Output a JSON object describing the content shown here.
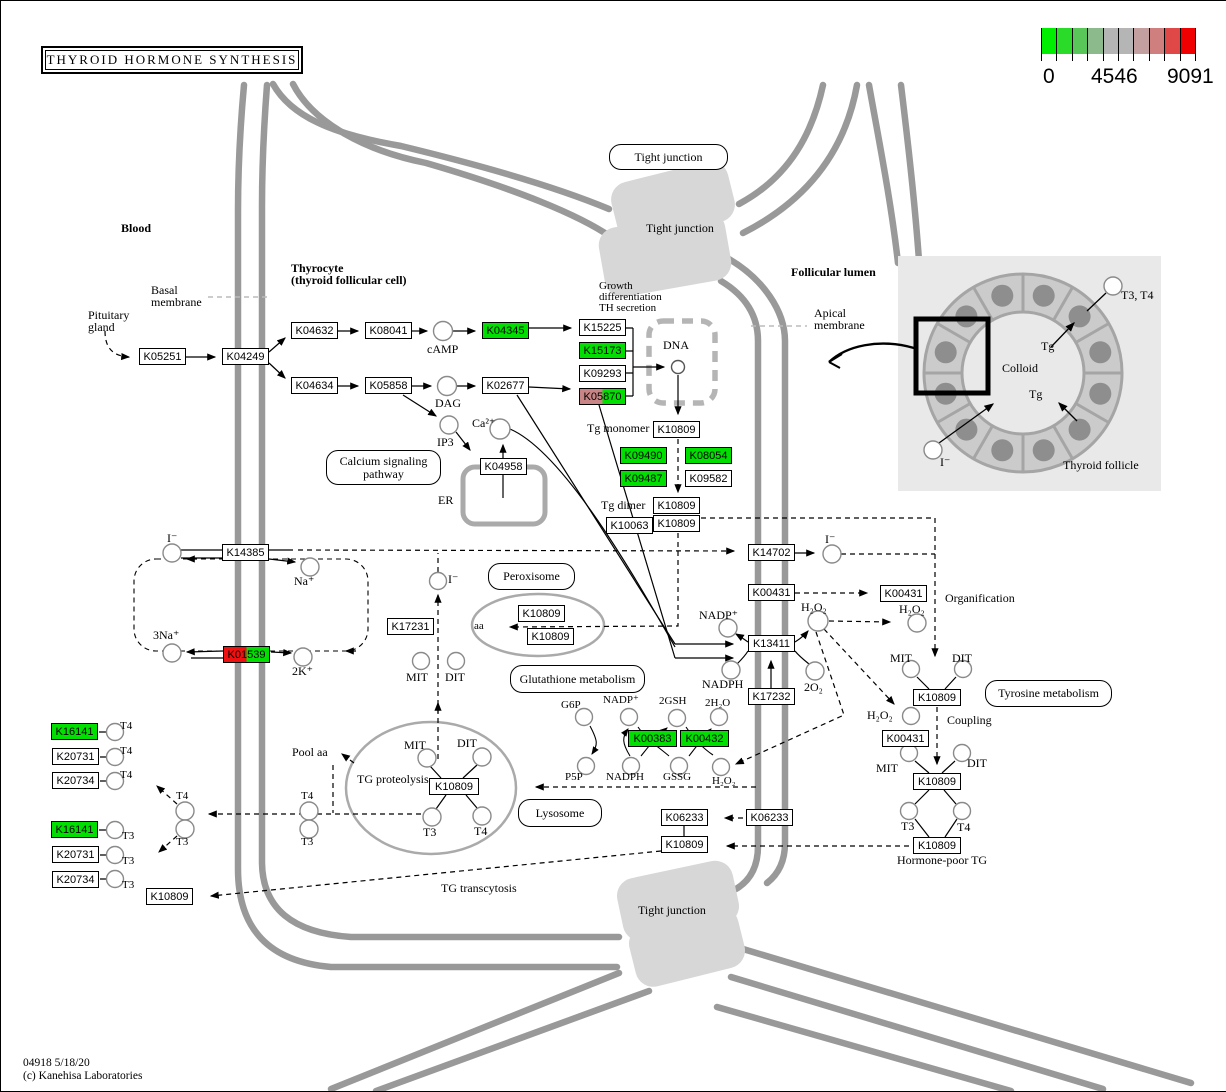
{
  "title": "THYROID HORMONE SYNTHESIS",
  "legend": {
    "ticks": [
      "0",
      "4546",
      "9091"
    ],
    "colors": [
      "#00EE00",
      "#2ADB2A",
      "#59C659",
      "#8CBA8C",
      "#B5B5B5",
      "#B5B5B5",
      "#C49F9F",
      "#D07F7F",
      "#E04848",
      "#F00000"
    ]
  },
  "footer": {
    "line1": "04918 5/18/20",
    "line2": "(c) Kanehisa Laboratories"
  },
  "box_colors": {
    "green": "#00DF00",
    "red": "#F01010",
    "rose": "#C98585",
    "white": "#FFFFFF"
  },
  "pathway_links": [
    {
      "lines": [
        "Tight junction"
      ],
      "x": 608,
      "y": 143,
      "w": 119,
      "h": 26
    },
    {
      "lines": [
        "Calcium signaling",
        "pathway"
      ],
      "x": 325,
      "y": 449,
      "w": 115,
      "h": 35
    },
    {
      "lines": [
        "Peroxisome"
      ],
      "x": 487,
      "y": 562,
      "w": 87,
      "h": 27
    },
    {
      "lines": [
        "Glutathione metabolism"
      ],
      "x": 509,
      "y": 664,
      "w": 135,
      "h": 28
    },
    {
      "lines": [
        "Lysosome"
      ],
      "x": 517,
      "y": 798,
      "w": 84,
      "h": 28
    },
    {
      "lines": [
        "Tyrosine metabolism"
      ],
      "x": 984,
      "y": 679,
      "w": 127,
      "h": 27
    }
  ],
  "ko_boxes": [
    {
      "label": "K05251",
      "x": 138,
      "y": 347
    },
    {
      "label": "K04249",
      "x": 221,
      "y": 347
    },
    {
      "label": "K04632",
      "x": 290,
      "y": 321
    },
    {
      "label": "K08041",
      "x": 364,
      "y": 321
    },
    {
      "label": "K04345",
      "x": 481,
      "y": 321,
      "c": "#00DF00"
    },
    {
      "label": "K15225",
      "x": 578,
      "y": 318
    },
    {
      "label": "K15173",
      "x": 578,
      "y": 341,
      "c": "#00DF00"
    },
    {
      "label": "K09293",
      "x": 578,
      "y": 364
    },
    {
      "label": "K05870",
      "x": 578,
      "y": 387,
      "c": "#C98585",
      "c2": "#00DF00"
    },
    {
      "label": "K04634",
      "x": 290,
      "y": 376
    },
    {
      "label": "K05858",
      "x": 364,
      "y": 376
    },
    {
      "label": "K02677",
      "x": 481,
      "y": 376
    },
    {
      "label": "K04958",
      "x": 479,
      "y": 457
    },
    {
      "label": "K10809",
      "x": 652,
      "y": 420
    },
    {
      "label": "K09490",
      "x": 619,
      "y": 446,
      "c": "#00DF00"
    },
    {
      "label": "K08054",
      "x": 684,
      "y": 446,
      "c": "#00DF00"
    },
    {
      "label": "K09487",
      "x": 619,
      "y": 469,
      "c": "#00DF00"
    },
    {
      "label": "K09582",
      "x": 684,
      "y": 469
    },
    {
      "label": "K10809",
      "x": 652,
      "y": 496
    },
    {
      "label": "K10809",
      "x": 652,
      "y": 514
    },
    {
      "label": "K10063",
      "x": 605,
      "y": 516
    },
    {
      "label": "K14385",
      "x": 221,
      "y": 543
    },
    {
      "label": "K01539",
      "x": 222,
      "y": 645,
      "c": "#F01010",
      "c2": "#00DF00"
    },
    {
      "label": "K17231",
      "x": 386,
      "y": 617
    },
    {
      "label": "K14702",
      "x": 747,
      "y": 543
    },
    {
      "label": "K00431",
      "x": 747,
      "y": 583
    },
    {
      "label": "K13411",
      "x": 747,
      "y": 634
    },
    {
      "label": "K17232",
      "x": 747,
      "y": 687
    },
    {
      "label": "K00431",
      "x": 879,
      "y": 584
    },
    {
      "label": "K10809",
      "x": 517,
      "y": 604
    },
    {
      "label": "K10809",
      "x": 526,
      "y": 627
    },
    {
      "label": "K00383",
      "x": 627,
      "y": 729,
      "c": "#00DF00",
      "w": 49
    },
    {
      "label": "K00432",
      "x": 679,
      "y": 729,
      "c": "#00DF00",
      "w": 49
    },
    {
      "label": "K10809",
      "x": 428,
      "y": 777,
      "w": 50
    },
    {
      "label": "K16141",
      "x": 50,
      "y": 722,
      "c": "#00DF00"
    },
    {
      "label": "K20731",
      "x": 51,
      "y": 747
    },
    {
      "label": "K20734",
      "x": 51,
      "y": 771
    },
    {
      "label": "K16141",
      "x": 50,
      "y": 820,
      "c": "#00DF00"
    },
    {
      "label": "K20731",
      "x": 51,
      "y": 845
    },
    {
      "label": "K20734",
      "x": 51,
      "y": 870
    },
    {
      "label": "K10809",
      "x": 145,
      "y": 887
    },
    {
      "label": "K06233",
      "x": 660,
      "y": 808
    },
    {
      "label": "K10809",
      "x": 660,
      "y": 835
    },
    {
      "label": "K06233",
      "x": 745,
      "y": 808
    },
    {
      "label": "K10809",
      "x": 912,
      "y": 688,
      "w": 48
    },
    {
      "label": "K00431",
      "x": 881,
      "y": 729
    },
    {
      "label": "K10809",
      "x": 912,
      "y": 772,
      "w": 48
    },
    {
      "label": "K10809",
      "x": 912,
      "y": 836,
      "w": 48
    }
  ],
  "metabolites": [
    {
      "name": "cAMP",
      "cx": 442,
      "cy": 330,
      "r": 9.5
    },
    {
      "name": "DAG",
      "cx": 446,
      "cy": 385,
      "r": 9.5
    },
    {
      "name": "IP3",
      "cx": 448,
      "cy": 424,
      "r": 9
    },
    {
      "name": "Ca2+",
      "cx": 499,
      "cy": 428,
      "r": 10
    },
    {
      "name": "DNA-site",
      "cx": 677,
      "cy": 366,
      "r": 6.5
    },
    {
      "name": "iodide-blood",
      "cx": 171,
      "cy": 552,
      "r": 9
    },
    {
      "name": "Na+",
      "cx": 309,
      "cy": 566,
      "r": 9
    },
    {
      "name": "3Na+",
      "cx": 171,
      "cy": 652,
      "r": 9
    },
    {
      "name": "2K+",
      "cx": 302,
      "cy": 656,
      "r": 9
    },
    {
      "name": "iodide-recycled",
      "cx": 437,
      "cy": 580,
      "r": 8.5
    },
    {
      "name": "MIT-dehal",
      "cx": 420,
      "cy": 660,
      "r": 8.5
    },
    {
      "name": "DIT-dehal",
      "cx": 455,
      "cy": 660,
      "r": 8.5
    },
    {
      "name": "T4-blood",
      "cx": 184,
      "cy": 810,
      "r": 9
    },
    {
      "name": "T3-blood",
      "cx": 184,
      "cy": 828,
      "r": 9
    },
    {
      "name": "T4-cell",
      "cx": 308,
      "cy": 810,
      "r": 9
    },
    {
      "name": "T3-cell",
      "cx": 308,
      "cy": 828,
      "r": 9
    },
    {
      "name": "T4-transport-1",
      "cx": 114,
      "cy": 731,
      "r": 8.5
    },
    {
      "name": "T4-transport-2",
      "cx": 114,
      "cy": 756,
      "r": 8.5
    },
    {
      "name": "T4-transport-3",
      "cx": 114,
      "cy": 780,
      "r": 8.5
    },
    {
      "name": "T3-transport-1",
      "cx": 114,
      "cy": 829,
      "r": 8.5
    },
    {
      "name": "T3-transport-2",
      "cx": 114,
      "cy": 854,
      "r": 8.5
    },
    {
      "name": "T3-transport-3",
      "cx": 114,
      "cy": 878,
      "r": 8.5
    },
    {
      "name": "MIT-lysosome",
      "cx": 426,
      "cy": 757,
      "r": 9
    },
    {
      "name": "DIT-lysosome",
      "cx": 481,
      "cy": 756,
      "r": 9
    },
    {
      "name": "T3-lysosome",
      "cx": 431,
      "cy": 816,
      "r": 9
    },
    {
      "name": "T4-lysosome",
      "cx": 481,
      "cy": 815,
      "r": 9
    },
    {
      "name": "G6P",
      "cx": 583,
      "cy": 716,
      "r": 8.5
    },
    {
      "name": "NADP-glut",
      "cx": 628,
      "cy": 716,
      "r": 8.5
    },
    {
      "name": "2GSH",
      "cx": 676,
      "cy": 717,
      "r": 8.5
    },
    {
      "name": "2H2O",
      "cx": 718,
      "cy": 716,
      "r": 8.5
    },
    {
      "name": "P5P",
      "cx": 585,
      "cy": 765,
      "r": 8.5
    },
    {
      "name": "NADPH-glut",
      "cx": 630,
      "cy": 765,
      "r": 8.5
    },
    {
      "name": "GSSG",
      "cx": 678,
      "cy": 765,
      "r": 8.5
    },
    {
      "name": "H2O2-glut",
      "cx": 720,
      "cy": 766,
      "r": 8.5
    },
    {
      "name": "NADP-duox",
      "cx": 727,
      "cy": 627,
      "r": 9
    },
    {
      "name": "NADPH-duox",
      "cx": 730,
      "cy": 669,
      "r": 9
    },
    {
      "name": "H2O2-apical",
      "cx": 817,
      "cy": 620,
      "r": 10
    },
    {
      "name": "2O2",
      "cx": 814,
      "cy": 670,
      "r": 9
    },
    {
      "name": "iodide-lumen",
      "cx": 831,
      "cy": 553,
      "r": 9
    },
    {
      "name": "H2O2-organification",
      "cx": 916,
      "cy": 622,
      "r": 9
    },
    {
      "name": "MIT-lumen",
      "cx": 910,
      "cy": 668,
      "r": 8.5
    },
    {
      "name": "DIT-lumen",
      "cx": 962,
      "cy": 668,
      "r": 8.5
    },
    {
      "name": "H2O2-coupling",
      "cx": 910,
      "cy": 715,
      "r": 8.5
    },
    {
      "name": "MIT-coupling",
      "cx": 908,
      "cy": 752,
      "r": 8.5
    },
    {
      "name": "DIT-coupling",
      "cx": 961,
      "cy": 752,
      "r": 8.5
    },
    {
      "name": "T3-lumen",
      "cx": 908,
      "cy": 810,
      "r": 8.5
    },
    {
      "name": "T4-lumen",
      "cx": 961,
      "cy": 810,
      "r": 8.5
    },
    {
      "name": "T3T4-follicle",
      "cx": 1112,
      "cy": 285,
      "r": 9
    },
    {
      "name": "iodide-follicle",
      "cx": 932,
      "cy": 449,
      "r": 9
    }
  ],
  "labels": [
    {
      "t": "Blood",
      "x": 120,
      "y": 221,
      "b": 1
    },
    {
      "t": "Thyrocyte",
      "x": 290,
      "y": 261,
      "b": 1
    },
    {
      "t": "(thyroid follicular cell)",
      "x": 290,
      "y": 273,
      "b": 1
    },
    {
      "t": "Follicular lumen",
      "x": 790,
      "y": 265,
      "b": 1
    },
    {
      "t": "Basal",
      "x": 150,
      "y": 283
    },
    {
      "t": "membrane",
      "x": 150,
      "y": 295
    },
    {
      "t": "Pituitary",
      "x": 87,
      "y": 308
    },
    {
      "t": "gland",
      "x": 87,
      "y": 320
    },
    {
      "t": "Apical",
      "x": 813,
      "y": 306
    },
    {
      "t": "membrane",
      "x": 813,
      "y": 318
    },
    {
      "t": "Growth",
      "x": 598,
      "y": 279,
      "s": 11
    },
    {
      "t": "differentiation",
      "x": 598,
      "y": 290,
      "s": 11
    },
    {
      "t": "TH secretion",
      "x": 598,
      "y": 301,
      "s": 11
    },
    {
      "t": "cAMP",
      "x": 426,
      "y": 342
    },
    {
      "t": "DAG",
      "x": 434,
      "y": 396
    },
    {
      "t": "IP3",
      "x": 436,
      "y": 435
    },
    {
      "t": "Ca²⁺",
      "x": 471,
      "y": 416
    },
    {
      "t": "ER",
      "x": 437,
      "y": 493
    },
    {
      "t": "DNA",
      "x": 662,
      "y": 338
    },
    {
      "t": "Tg monomer",
      "x": 586,
      "y": 421
    },
    {
      "t": "Tg dimer",
      "x": 600,
      "y": 498
    },
    {
      "t": "aa",
      "x": 473,
      "y": 619,
      "s": 11
    },
    {
      "t": "I⁻",
      "x": 166,
      "y": 531
    },
    {
      "t": "Na⁺",
      "x": 293,
      "y": 574
    },
    {
      "t": "3Na⁺",
      "x": 152,
      "y": 628
    },
    {
      "t": "2K⁺",
      "x": 291,
      "y": 664
    },
    {
      "t": "I⁻",
      "x": 447,
      "y": 572
    },
    {
      "t": "MIT",
      "x": 405,
      "y": 670
    },
    {
      "t": "DIT",
      "x": 444,
      "y": 670
    },
    {
      "t": "NADP⁺",
      "x": 698,
      "y": 608
    },
    {
      "t": "NADPH",
      "x": 701,
      "y": 677
    },
    {
      "t": "H₂O₂",
      "x": 800,
      "y": 600
    },
    {
      "t": "2O₂",
      "x": 803,
      "y": 680
    },
    {
      "t": "H₂O₂",
      "x": 898,
      "y": 602
    },
    {
      "t": "I⁻",
      "x": 824,
      "y": 532
    },
    {
      "t": "Organification",
      "x": 944,
      "y": 591
    },
    {
      "t": "MIT",
      "x": 889,
      "y": 651
    },
    {
      "t": "DIT",
      "x": 951,
      "y": 651
    },
    {
      "t": "H₂O₂",
      "x": 866,
      "y": 708
    },
    {
      "t": "Coupling",
      "x": 946,
      "y": 713
    },
    {
      "t": "MIT",
      "x": 875,
      "y": 761
    },
    {
      "t": "DIT",
      "x": 966,
      "y": 756
    },
    {
      "t": "T3",
      "x": 900,
      "y": 819
    },
    {
      "t": "T4",
      "x": 956,
      "y": 820
    },
    {
      "t": "Hormone-poor TG",
      "x": 896,
      "y": 853
    },
    {
      "t": "G6P",
      "x": 560,
      "y": 698,
      "s": 11
    },
    {
      "t": "NADP⁺",
      "x": 602,
      "y": 693,
      "s": 11
    },
    {
      "t": "2GSH",
      "x": 658,
      "y": 694,
      "s": 11
    },
    {
      "t": "2H₂O",
      "x": 704,
      "y": 696,
      "s": 11
    },
    {
      "t": "P5P",
      "x": 564,
      "y": 770,
      "s": 11
    },
    {
      "t": "NADPH",
      "x": 605,
      "y": 770,
      "s": 11
    },
    {
      "t": "GSSG",
      "x": 662,
      "y": 770,
      "s": 11
    },
    {
      "t": "H₂O₂",
      "x": 711,
      "y": 774,
      "s": 11
    },
    {
      "t": "TG proteolysis",
      "x": 356,
      "y": 772
    },
    {
      "t": "MIT",
      "x": 403,
      "y": 738
    },
    {
      "t": "DIT",
      "x": 456,
      "y": 736
    },
    {
      "t": "T3",
      "x": 422,
      "y": 825
    },
    {
      "t": "T4",
      "x": 473,
      "y": 824
    },
    {
      "t": "Pool aa",
      "x": 291,
      "y": 745
    },
    {
      "t": "T4",
      "x": 119,
      "y": 719,
      "s": 11
    },
    {
      "t": "T4",
      "x": 119,
      "y": 744,
      "s": 11
    },
    {
      "t": "T4",
      "x": 119,
      "y": 768,
      "s": 11
    },
    {
      "t": "T3",
      "x": 121,
      "y": 829,
      "s": 11
    },
    {
      "t": "T3",
      "x": 121,
      "y": 854,
      "s": 11
    },
    {
      "t": "T3",
      "x": 121,
      "y": 878,
      "s": 11
    },
    {
      "t": "T4",
      "x": 175,
      "y": 789,
      "s": 11
    },
    {
      "t": "T3",
      "x": 175,
      "y": 835,
      "s": 11
    },
    {
      "t": "T4",
      "x": 300,
      "y": 789,
      "s": 11
    },
    {
      "t": "T3",
      "x": 300,
      "y": 835,
      "s": 11
    },
    {
      "t": "TG transcytosis",
      "x": 440,
      "y": 881
    },
    {
      "t": "Tight junction",
      "x": 645,
      "y": 221
    },
    {
      "t": "Tight junction",
      "x": 637,
      "y": 903
    },
    {
      "t": "Colloid",
      "x": 1001,
      "y": 361
    },
    {
      "t": "Tg",
      "x": 1040,
      "y": 339
    },
    {
      "t": "Tg",
      "x": 1028,
      "y": 387
    },
    {
      "t": "I⁻",
      "x": 939,
      "y": 455
    },
    {
      "t": "T3, T4",
      "x": 1120,
      "y": 288
    },
    {
      "t": "Thyroid follicle",
      "x": 1062,
      "y": 458
    }
  ]
}
